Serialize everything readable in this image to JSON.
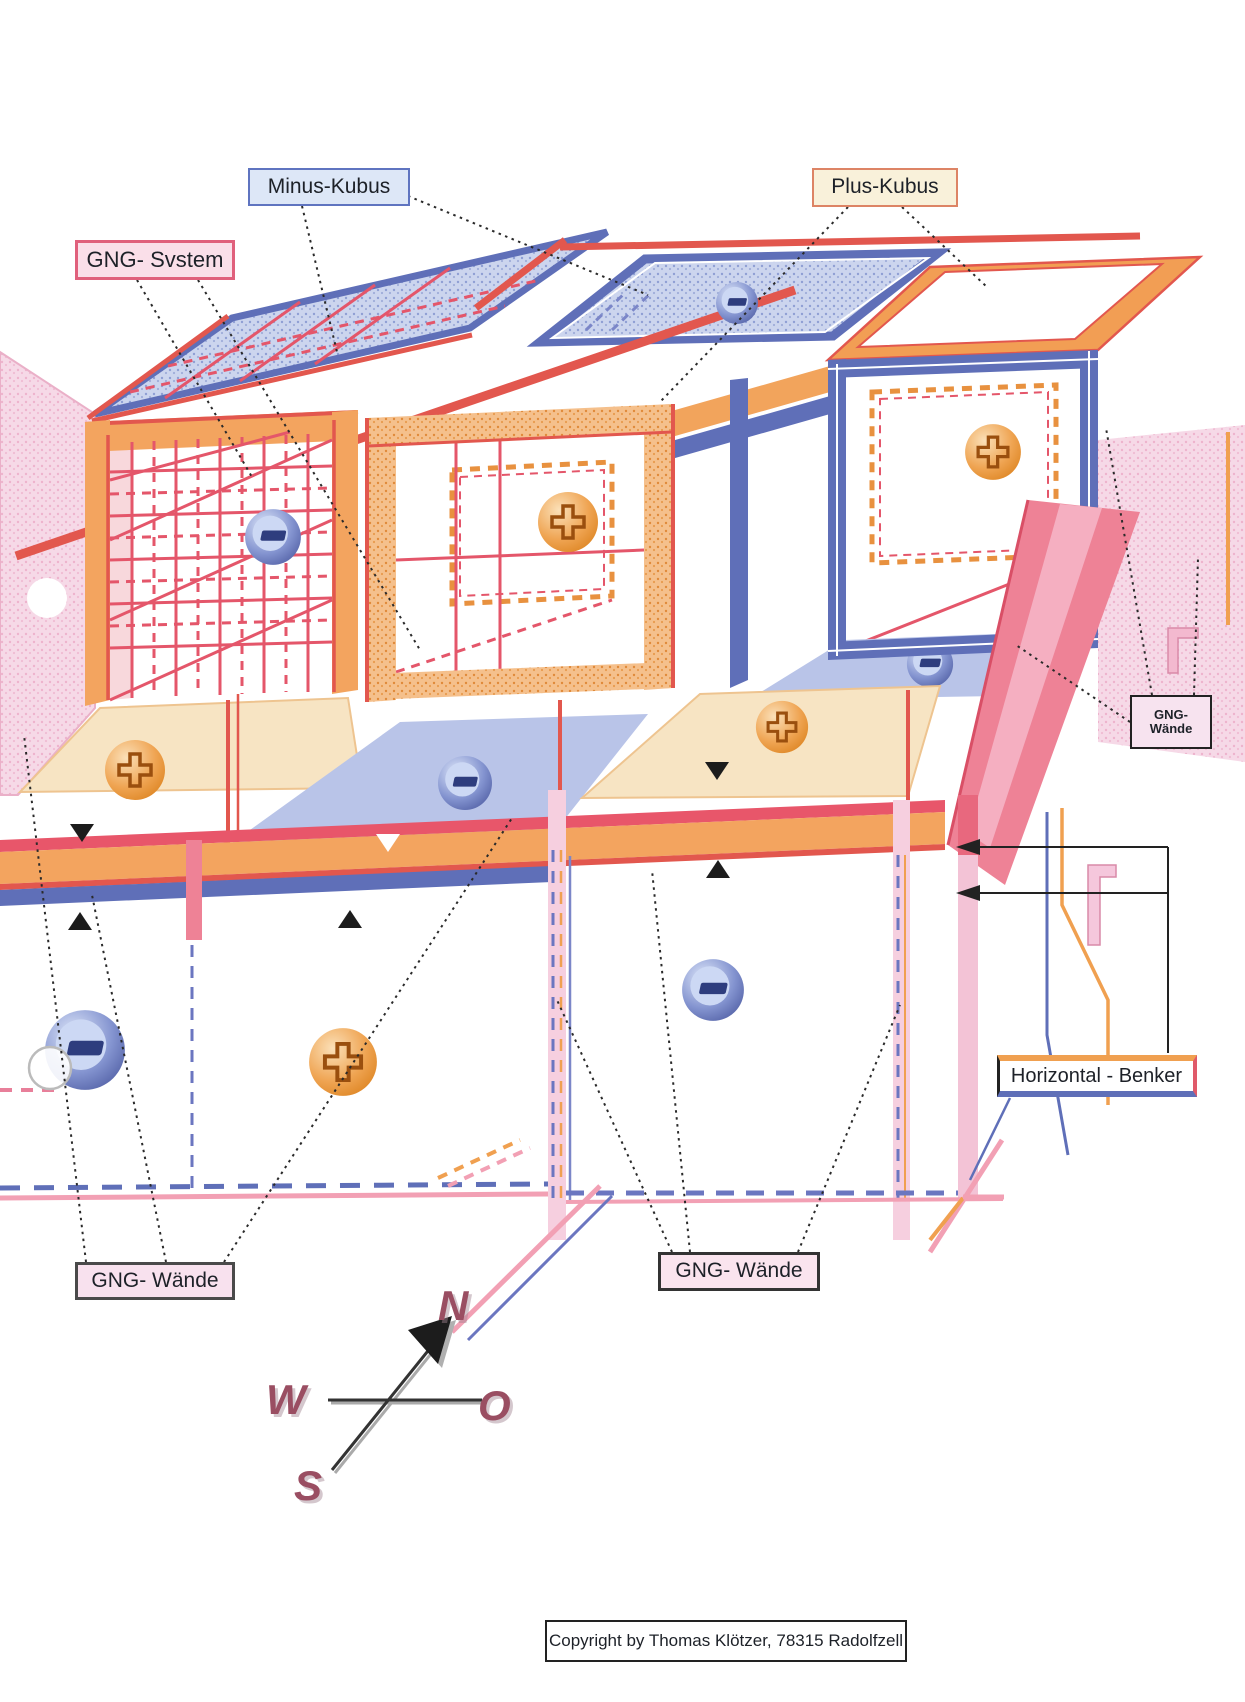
{
  "figure": {
    "title_labels": {
      "minus_kubus": "Minus-Kubus",
      "plus_kubus": "Plus-Kubus",
      "gng_system": "GNG- Svstem",
      "gng_waende_right_l1": "GNG-",
      "gng_waende_right_l2": "Wände",
      "horizontal_benker": "Horizontal - Benker",
      "gng_waende_bottom_left": "GNG- Wände",
      "gng_waende_bottom_mid": "GNG- Wände"
    },
    "compass": {
      "north": "N",
      "west": "W",
      "east": "O",
      "south": "S"
    },
    "copyright": "Copyright by Thomas Klötzer, 78315 Radolfzell",
    "symbols": {
      "plus": "+",
      "minus": "−"
    },
    "colors": {
      "orange_frame": "#f29e54",
      "blue_frame": "#5f6fb8",
      "red_grid": "#e4566a",
      "pink_beam": "#ee8296",
      "pink_wall": "#f5d3e4",
      "cream_floor": "#f7e4c3",
      "blue_floor": "#b9c4e8",
      "compass_letters": "#9a4e62"
    }
  }
}
